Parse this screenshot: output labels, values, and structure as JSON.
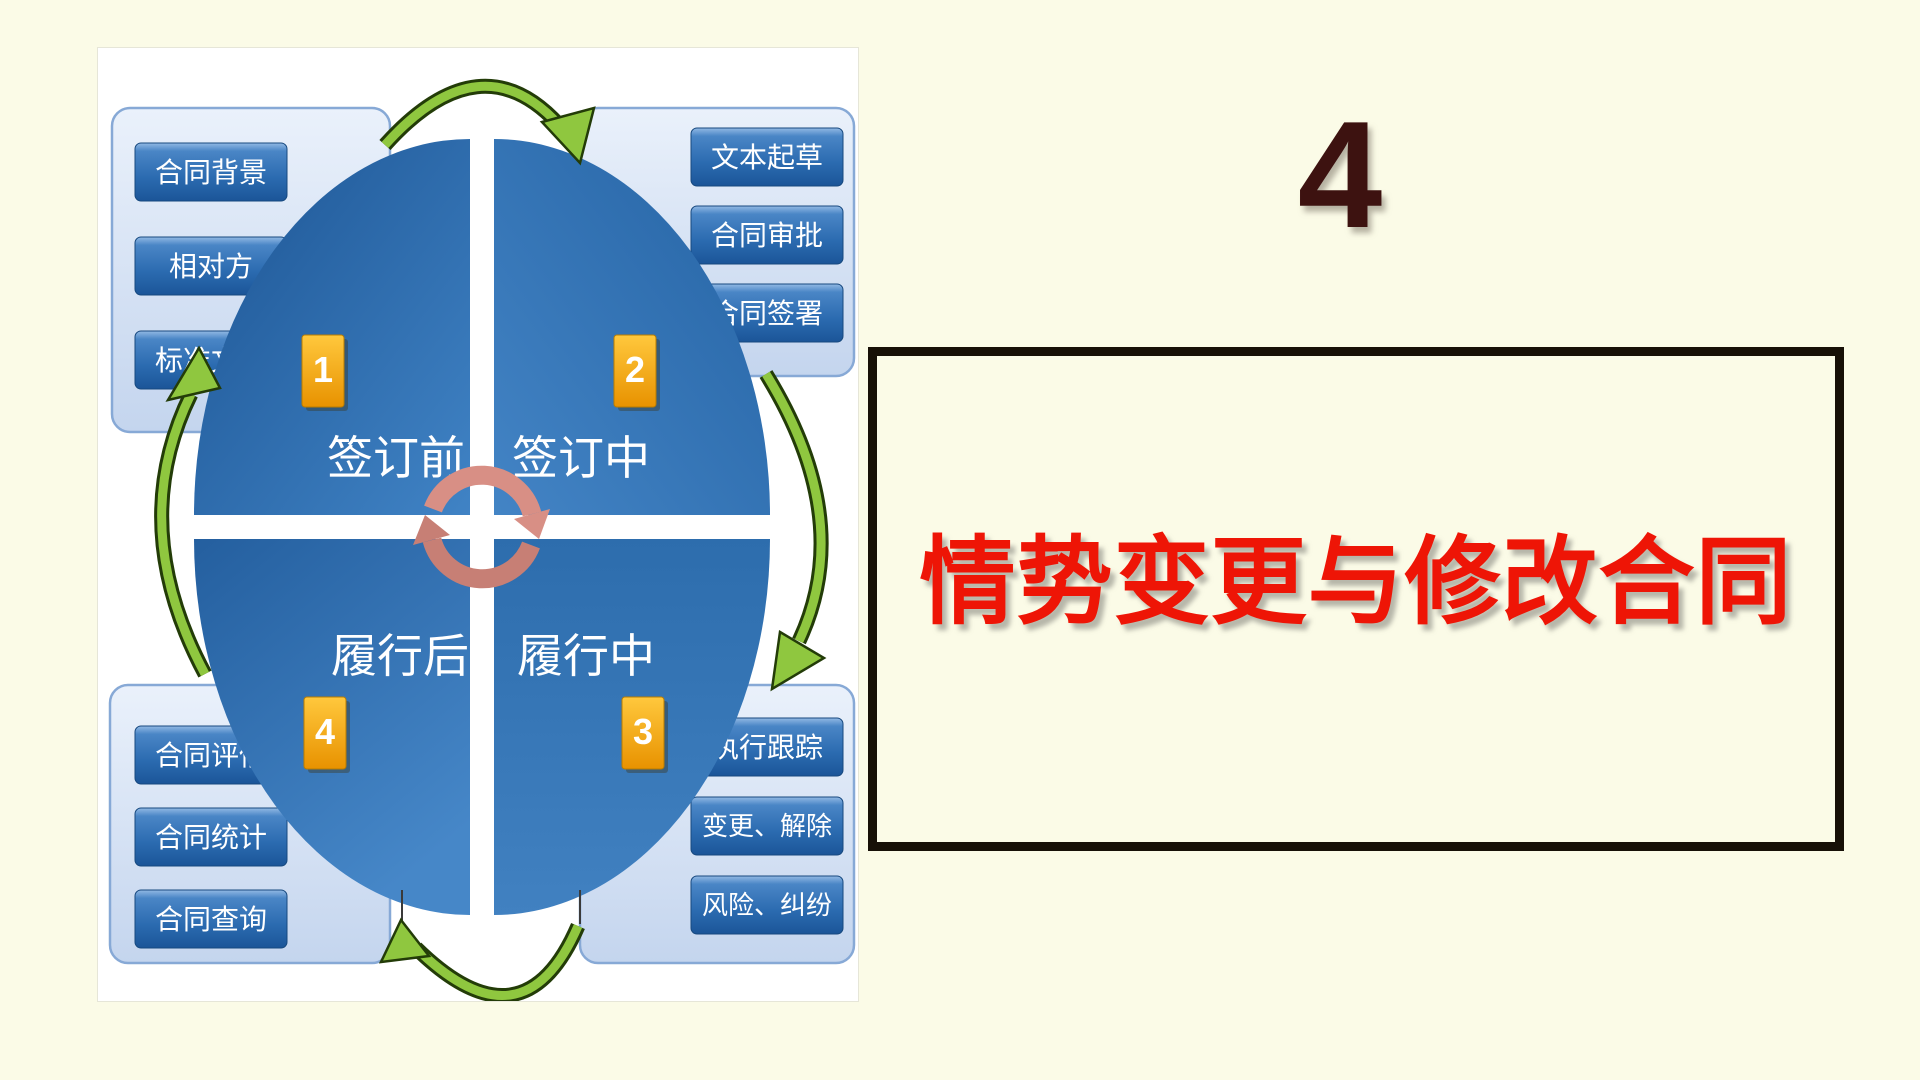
{
  "slide": {
    "section_number": "4",
    "title": "情势变更与修改合同",
    "colors": {
      "background": "#fbfbe7",
      "title_red": "#ee1506",
      "number_maroon": "#3d1210",
      "box_border": "#171007"
    }
  },
  "diagram": {
    "colors": {
      "ellipse_blue": "#2e6fb0",
      "panel_light_blue": "#d9e5f4",
      "button_blue": "#2b6bb0",
      "badge_orange": "#f2a202",
      "arrow_green": "#8fc73f",
      "center_arrows_salmon": "#cf837a"
    },
    "quadrants": [
      {
        "badge": "1",
        "label": "签订前"
      },
      {
        "badge": "2",
        "label": "签订中"
      },
      {
        "badge": "3",
        "label": "履行中"
      },
      {
        "badge": "4",
        "label": "履行后"
      }
    ],
    "panels": {
      "top_left": {
        "buttons": [
          "合同背景",
          "相对方",
          "标准文本"
        ]
      },
      "top_right": {
        "buttons": [
          "文本起草",
          "合同审批",
          "合同签署"
        ]
      },
      "bottom_right": {
        "buttons": [
          "执行跟踪",
          "变更、解除",
          "风险、纠纷"
        ]
      },
      "bottom_left": {
        "buttons": [
          "合同评估",
          "合同统计",
          "合同查询"
        ]
      }
    }
  }
}
